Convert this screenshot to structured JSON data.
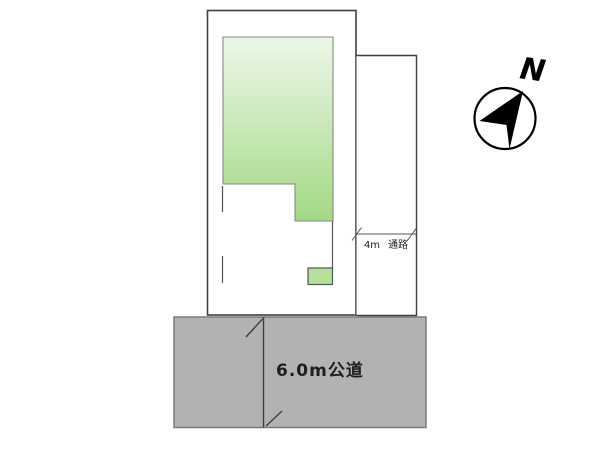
{
  "site_plan": {
    "passage": {
      "width_label": "4m",
      "name_label": "通路"
    },
    "road_label": "6.0m公道",
    "compass": {
      "north_label": "N"
    }
  },
  "colors": {
    "outline-dark": "#3f3f3f",
    "thin-line": "#555555",
    "land-border": "#7d8f78",
    "land-green-top": "#edf7e8",
    "land-green-bottom": "#a3d985",
    "entrance-green": "#b4e09c",
    "entrance-border": "#4e5c4c",
    "road-gray": "#b2b2b2",
    "road-border": "#7a7a7a",
    "label-ink": "#1e1e1e"
  }
}
